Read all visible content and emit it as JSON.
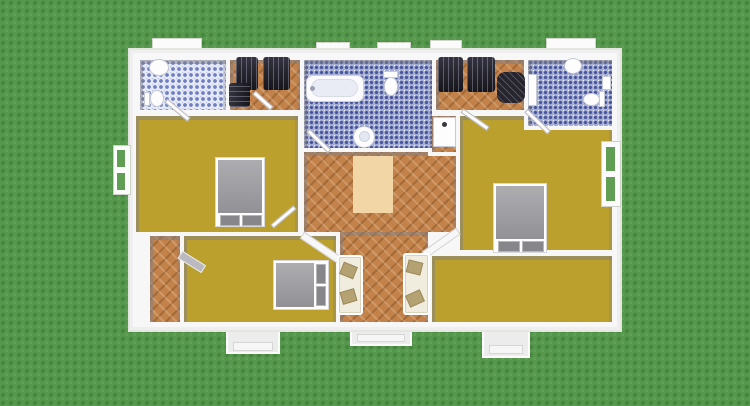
{
  "scene": {
    "type": "3d-floorplan-top-view",
    "palette": {
      "grass": "#55984c",
      "wall_white": "#f7f7f7",
      "wall_shadow_gray": "#7d7d84",
      "floor_mustard": "#bca02e",
      "floor_wood": "#c2824a",
      "tile_blue": "#a8b1d5",
      "tile_blue_dot": "#46549b",
      "tile_white": "#e8eaf3",
      "bed_gray": "#9b9b9f",
      "wardrobe_dark": "#22212a",
      "sofa_cream": "#f1edde",
      "cushion_tan": "#b5a273",
      "rug_beige": "#f3d6a6"
    },
    "house": {
      "x": 128,
      "y": 48,
      "w": 494,
      "h": 284
    },
    "elements": [
      {
        "n": "window-sill-top-1",
        "c": "sill",
        "x": 152,
        "y": 38,
        "w": 50,
        "h": 13,
        "i": false
      },
      {
        "n": "window-sill-top-2",
        "c": "sill",
        "x": 316,
        "y": 42,
        "w": 34,
        "h": 11,
        "i": false
      },
      {
        "n": "window-sill-top-3",
        "c": "sill",
        "x": 377,
        "y": 42,
        "w": 34,
        "h": 11,
        "i": false
      },
      {
        "n": "window-sill-top-4",
        "c": "sill",
        "x": 430,
        "y": 40,
        "w": 32,
        "h": 12,
        "i": false
      },
      {
        "n": "window-sill-top-5",
        "c": "sill",
        "x": 546,
        "y": 38,
        "w": 50,
        "h": 13,
        "i": false
      },
      {
        "n": "left-porch",
        "c": "porch",
        "x": 226,
        "y": 322,
        "w": 54,
        "h": 32,
        "i": false
      },
      {
        "n": "left-porch-step",
        "c": "step-light",
        "x": 233,
        "y": 342,
        "w": 40,
        "h": 9,
        "i": false
      },
      {
        "n": "front-entry-steps",
        "c": "porch",
        "x": 350,
        "y": 324,
        "w": 62,
        "h": 22,
        "i": false
      },
      {
        "n": "front-entry-step",
        "c": "step-light",
        "x": 357,
        "y": 334,
        "w": 48,
        "h": 8,
        "i": false
      },
      {
        "n": "right-porch",
        "c": "porch",
        "x": 482,
        "y": 322,
        "w": 48,
        "h": 36,
        "i": false
      },
      {
        "n": "right-porch-step",
        "c": "step-light",
        "x": 489,
        "y": 345,
        "w": 34,
        "h": 9,
        "i": false
      },
      {
        "n": "house-shell",
        "c": "house",
        "x": 128,
        "y": 48,
        "w": 494,
        "h": 284,
        "i": false
      },
      {
        "n": "room-top-left-bedroom",
        "c": "room floor-mustard",
        "x": 136,
        "y": 116,
        "w": 162,
        "h": 116,
        "i": true
      },
      {
        "n": "room-bottom-left-bedroom",
        "c": "room floor-mustard",
        "x": 184,
        "y": 236,
        "w": 152,
        "h": 86,
        "i": true
      },
      {
        "n": "room-right-bedroom",
        "c": "room floor-mustard",
        "x": 460,
        "y": 116,
        "w": 152,
        "h": 134,
        "i": true
      },
      {
        "n": "room-right-lower",
        "c": "room floor-mustard",
        "x": 432,
        "y": 256,
        "w": 180,
        "h": 66,
        "i": true
      },
      {
        "n": "room-corridor",
        "c": "room floor-wood",
        "x": 150,
        "y": 236,
        "w": 30,
        "h": 86,
        "i": true
      },
      {
        "n": "room-hall-upper",
        "c": "room floor-wood",
        "x": 304,
        "y": 152,
        "w": 152,
        "h": 80,
        "i": true
      },
      {
        "n": "room-hall-lower",
        "c": "room floor-wood",
        "x": 340,
        "y": 232,
        "w": 88,
        "h": 90,
        "i": true
      },
      {
        "n": "room-shower-niche",
        "c": "room floor-wood ringed",
        "x": 432,
        "y": 116,
        "w": 24,
        "h": 36,
        "i": true
      },
      {
        "n": "room-left-bathroom",
        "c": "room floor-tile-white",
        "x": 140,
        "y": 60,
        "w": 86,
        "h": 50,
        "i": true
      },
      {
        "n": "room-left-closet",
        "c": "room floor-wood",
        "x": 230,
        "y": 60,
        "w": 70,
        "h": 50,
        "i": true
      },
      {
        "n": "room-central-bathroom",
        "c": "room floor-tile-blue",
        "x": 304,
        "y": 60,
        "w": 128,
        "h": 88,
        "i": true
      },
      {
        "n": "room-right-closet",
        "c": "room floor-wood",
        "x": 436,
        "y": 60,
        "w": 88,
        "h": 50,
        "i": true
      },
      {
        "n": "room-right-bathroom",
        "c": "room floor-tile-blue ringed",
        "x": 528,
        "y": 60,
        "w": 84,
        "h": 66,
        "i": true
      },
      {
        "n": "wall-angled-left",
        "c": "wall-angled",
        "x": 302,
        "y": 231,
        "w": 46,
        "h": 8,
        "r": 34,
        "i": false
      },
      {
        "n": "wall-angled-right",
        "c": "wall-angled",
        "x": 424,
        "y": 251,
        "w": 42,
        "h": 8,
        "r": -35,
        "i": false
      },
      {
        "n": "bed-double-frame",
        "c": "bed-frame",
        "x": 215,
        "y": 157,
        "w": 50,
        "h": 70,
        "i": true
      },
      {
        "n": "bed-double-mattress",
        "c": "mattress",
        "x": 218,
        "y": 160,
        "w": 44,
        "h": 53,
        "i": false
      },
      {
        "n": "bed-double-pillow-1",
        "c": "pillow",
        "x": 220,
        "y": 215,
        "w": 20,
        "h": 11,
        "i": false
      },
      {
        "n": "bed-double-pillow-2",
        "c": "pillow",
        "x": 242,
        "y": 215,
        "w": 20,
        "h": 11,
        "i": false
      },
      {
        "n": "bed-single-frame",
        "c": "bed-frame",
        "x": 273,
        "y": 260,
        "w": 56,
        "h": 50,
        "i": true
      },
      {
        "n": "bed-single-mattress",
        "c": "mattress",
        "x": 276,
        "y": 263,
        "w": 38,
        "h": 44,
        "i": false
      },
      {
        "n": "bed-single-pillow-1",
        "c": "pillow",
        "x": 316,
        "y": 264,
        "w": 10,
        "h": 20,
        "i": false
      },
      {
        "n": "bed-single-pillow-2",
        "c": "pillow",
        "x": 316,
        "y": 286,
        "w": 10,
        "h": 20,
        "i": false
      },
      {
        "n": "bed-master-frame",
        "c": "bed-frame",
        "x": 493,
        "y": 183,
        "w": 54,
        "h": 70,
        "i": true
      },
      {
        "n": "bed-master-mattress",
        "c": "mattress",
        "x": 496,
        "y": 186,
        "w": 48,
        "h": 53,
        "i": false
      },
      {
        "n": "bed-master-pillow-1",
        "c": "pillow",
        "x": 498,
        "y": 241,
        "w": 22,
        "h": 11,
        "i": false
      },
      {
        "n": "bed-master-pillow-2",
        "c": "pillow",
        "x": 522,
        "y": 241,
        "w": 22,
        "h": 11,
        "i": false
      },
      {
        "n": "wardrobe-1",
        "c": "wardrobe",
        "x": 236,
        "y": 57,
        "w": 22,
        "h": 33,
        "i": true
      },
      {
        "n": "wardrobe-2",
        "c": "wardrobe",
        "x": 263,
        "y": 57,
        "w": 27,
        "h": 33,
        "i": true
      },
      {
        "n": "wardrobe-3",
        "c": "wardrobe-h",
        "x": 229,
        "y": 83,
        "w": 21,
        "h": 24,
        "i": true
      },
      {
        "n": "wardrobe-4",
        "c": "wardrobe",
        "x": 438,
        "y": 57,
        "w": 25,
        "h": 35,
        "i": true
      },
      {
        "n": "wardrobe-5",
        "c": "wardrobe",
        "x": 467,
        "y": 57,
        "w": 28,
        "h": 35,
        "i": true
      },
      {
        "n": "dark-armchair",
        "c": "dark-chair",
        "x": 497,
        "y": 72,
        "w": 28,
        "h": 31,
        "i": true
      },
      {
        "n": "bathtub",
        "c": "tub",
        "x": 306,
        "y": 75,
        "w": 58,
        "h": 27,
        "i": true
      },
      {
        "n": "bathtub-basin",
        "c": "tub-inner",
        "x": 311,
        "y": 79,
        "w": 47,
        "h": 18,
        "i": false
      },
      {
        "n": "bathtub-faucet",
        "c": "knob",
        "x": 310,
        "y": 86,
        "w": 5,
        "h": 5,
        "i": false
      },
      {
        "n": "toilet-central-tank",
        "c": "fixture",
        "x": 383,
        "y": 71,
        "w": 15,
        "h": 7,
        "i": false
      },
      {
        "n": "toilet-central-bowl",
        "c": "fixture oval",
        "x": 384,
        "y": 77,
        "w": 14,
        "h": 19,
        "i": true
      },
      {
        "n": "pedestal-sink",
        "c": "fixture oval",
        "x": 353,
        "y": 126,
        "w": 22,
        "h": 22,
        "i": true
      },
      {
        "n": "pedestal-sink-basin",
        "c": "oval basin-inner",
        "x": 359,
        "y": 131,
        "w": 11,
        "h": 11,
        "i": false
      },
      {
        "n": "sink-left",
        "c": "fixture oval",
        "x": 149,
        "y": 59,
        "w": 20,
        "h": 17,
        "i": true
      },
      {
        "n": "toilet-left-tank",
        "c": "fixture",
        "x": 144,
        "y": 92,
        "w": 6,
        "h": 14,
        "i": false
      },
      {
        "n": "toilet-left-bowl",
        "c": "fixture oval",
        "x": 150,
        "y": 90,
        "w": 14,
        "h": 17,
        "i": true
      },
      {
        "n": "shower-unit",
        "c": "fixture",
        "x": 433,
        "y": 117,
        "w": 23,
        "h": 30,
        "i": true
      },
      {
        "n": "shower-knob",
        "c": "knob-dark",
        "x": 442,
        "y": 122,
        "w": 5,
        "h": 5,
        "i": false
      },
      {
        "n": "sink-right",
        "c": "fixture oval",
        "x": 564,
        "y": 58,
        "w": 18,
        "h": 16,
        "i": true
      },
      {
        "n": "toilet-right-bowl",
        "c": "fixture oval",
        "x": 583,
        "y": 93,
        "w": 17,
        "h": 13,
        "i": true
      },
      {
        "n": "toilet-right-tank",
        "c": "fixture",
        "x": 599,
        "y": 91,
        "w": 6,
        "h": 16,
        "i": false
      },
      {
        "n": "shelf-right-bathroom",
        "c": "fixture",
        "x": 602,
        "y": 76,
        "w": 9,
        "h": 14,
        "i": false
      },
      {
        "n": "towel-rail",
        "c": "fixture",
        "x": 528,
        "y": 74,
        "w": 9,
        "h": 32,
        "i": false
      },
      {
        "n": "rug",
        "c": "rug",
        "x": 353,
        "y": 156,
        "w": 40,
        "h": 57,
        "i": true
      },
      {
        "n": "sofa-left",
        "c": "sofa",
        "x": 337,
        "y": 255,
        "w": 26,
        "h": 60,
        "i": true
      },
      {
        "n": "sofa-left-cushion-1",
        "c": "cushion",
        "x": 341,
        "y": 264,
        "w": 15,
        "h": 13,
        "r": 22,
        "i": false
      },
      {
        "n": "sofa-left-cushion-2",
        "c": "cushion",
        "x": 341,
        "y": 290,
        "w": 15,
        "h": 13,
        "r": -16,
        "i": false
      },
      {
        "n": "sofa-right",
        "c": "sofa",
        "x": 403,
        "y": 253,
        "w": 27,
        "h": 62,
        "i": true
      },
      {
        "n": "sofa-right-cushion-1",
        "c": "cushion",
        "x": 407,
        "y": 261,
        "w": 15,
        "h": 13,
        "r": 14,
        "i": false
      },
      {
        "n": "sofa-right-cushion-2",
        "c": "cushion",
        "x": 407,
        "y": 292,
        "w": 16,
        "h": 13,
        "r": -24,
        "i": false
      },
      {
        "n": "door-left-bathroom",
        "c": "door-leaf",
        "x": 166,
        "y": 98,
        "w": 30,
        "h": 5,
        "r": 40,
        "i": true
      },
      {
        "n": "door-left-closet",
        "c": "door-leaf",
        "x": 254,
        "y": 90,
        "w": 24,
        "h": 5,
        "r": 42,
        "i": true
      },
      {
        "n": "door-central-bathroom",
        "c": "door-leaf",
        "x": 308,
        "y": 128,
        "w": 30,
        "h": 5,
        "r": 44,
        "i": true
      },
      {
        "n": "door-right-closet",
        "c": "door-leaf",
        "x": 462,
        "y": 108,
        "w": 32,
        "h": 5,
        "r": 35,
        "i": true
      },
      {
        "n": "door-right-bathroom",
        "c": "door-leaf",
        "x": 526,
        "y": 108,
        "w": 32,
        "h": 5,
        "r": 44,
        "i": true
      },
      {
        "n": "door-top-left-bedroom",
        "c": "door-leaf",
        "x": 272,
        "y": 224,
        "w": 30,
        "h": 5,
        "r": -40,
        "i": true
      },
      {
        "n": "door-corridor",
        "c": "door-leaf-gray",
        "x": 180,
        "y": 250,
        "w": 28,
        "h": 9,
        "r": 32,
        "i": true
      },
      {
        "n": "window-left-frame",
        "c": "window-frame",
        "x": 113,
        "y": 145,
        "w": 18,
        "h": 50,
        "i": true
      },
      {
        "n": "window-left-pane-1",
        "c": "window-pane",
        "x": 115,
        "y": 148,
        "w": 12,
        "h": 21,
        "i": false
      },
      {
        "n": "window-left-pane-2",
        "c": "window-pane",
        "x": 115,
        "y": 171,
        "w": 12,
        "h": 21,
        "i": false
      },
      {
        "n": "window-right-frame",
        "c": "window-frame",
        "x": 601,
        "y": 141,
        "w": 20,
        "h": 66,
        "i": true
      },
      {
        "n": "window-right-pane-1",
        "c": "window-pane",
        "x": 604,
        "y": 145,
        "w": 13,
        "h": 28,
        "i": false
      },
      {
        "n": "window-right-pane-2",
        "c": "window-pane",
        "x": 604,
        "y": 175,
        "w": 13,
        "h": 28,
        "i": false
      }
    ]
  }
}
